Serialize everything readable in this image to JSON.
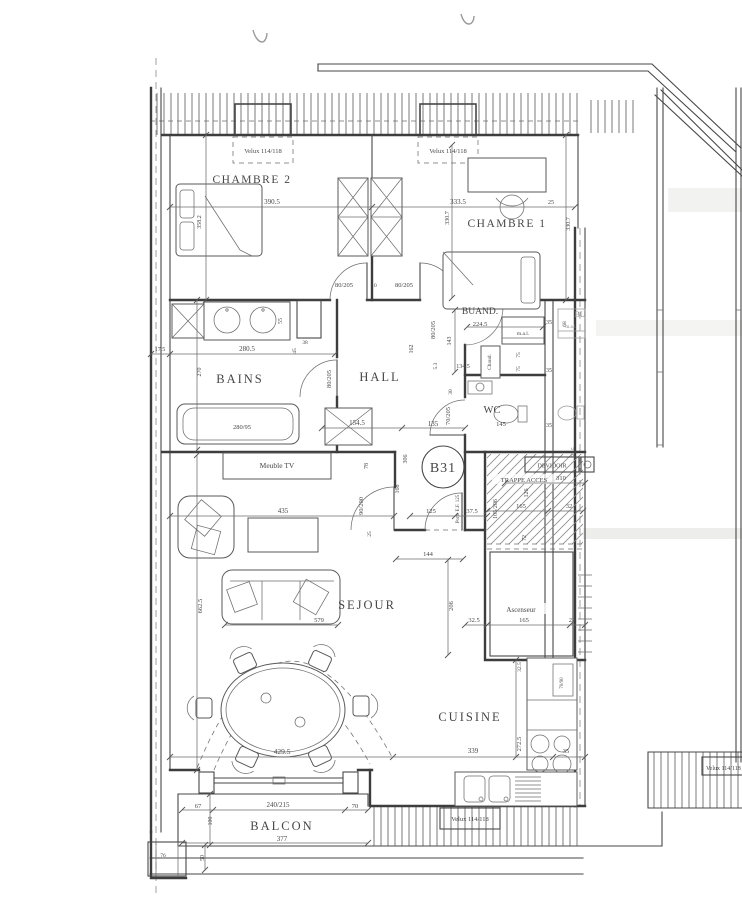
{
  "colors": {
    "ink": "#474747",
    "ink_heavy": "#3d3d3d",
    "paper": "#ffffff"
  },
  "unit": {
    "badge": "B31"
  },
  "rooms": {
    "chambre2": "CHAMBRE 2",
    "chambre1": "CHAMBRE 1",
    "bains": "BAINS",
    "hall": "HALL",
    "buand": "BUAND.",
    "wc": "WC",
    "sejour": "SEJOUR",
    "cuisine": "CUISINE",
    "balcon": "BALCON"
  },
  "labels": {
    "velux": "Velux 114/118",
    "meuble_tv": "Meuble TV",
    "machine_a_laver": "m.a.l.",
    "chaudiere": "Chaud.",
    "devidoir": "DEVIDOIR",
    "trappe_acces": "TRAPPE ACCES",
    "ascenseur": "Ascenseur",
    "porte_entree": "Porte E.F. 125",
    "voisin": "BU"
  },
  "dimensions": {
    "chambre2_largeur": "390.5",
    "chambre2_profondeur": "358.2",
    "chambre1_largeur": "333.5",
    "chambre1_profondeur": "330.7",
    "mur_droit": "25",
    "porte_80_205": "80/205",
    "ecart_portes": "10",
    "bains_retrait": "17.5",
    "bains_largeur": "280.5",
    "bains_profondeur": "270",
    "baignoire": "280/95",
    "gaine_55": "55",
    "gaine_38": "38",
    "gaine_45": "45",
    "placard_hall": "154.5",
    "hall_135": "135",
    "hall_162": "162",
    "buand_largeur": "224.5",
    "buand_143": "143",
    "buand_53": "5.3",
    "buand_1345": "134.5",
    "wc_30": "30",
    "porte_70_205": "70/205",
    "wc_largeur": "145",
    "gaine_75": "75",
    "couloir_35": "35",
    "mal_68": "68",
    "devidoir_310": "310",
    "gaine_375": "37.5",
    "gaine_126": "126",
    "trappe_105_206": "105/206",
    "gaine_165": "165",
    "gaine_32": "32",
    "gaine_72": "72",
    "entree_125": "125",
    "sejour_78": "78",
    "sejour_306": "306",
    "sejour_168": "168",
    "porte_90_200": "90/200",
    "sejour_25": "25",
    "sejour_144": "144",
    "sejour_largeur": "435",
    "sejour_profondeur": "662.5",
    "canape": "579",
    "sejour_206": "206",
    "ascenseur_325": "32.5",
    "ascenseur_22": "22",
    "sejour_baie": "429.5",
    "cuisine_largeur": "339",
    "cuisine_profondeur": "272.5",
    "frigo": "70/90",
    "balcon_67": "67",
    "baie_vitree": "240/215",
    "balcon_70": "70",
    "balcon_100": "100",
    "balcon_longueur": "377",
    "balcon_50": "50",
    "balcon_76": "76"
  }
}
